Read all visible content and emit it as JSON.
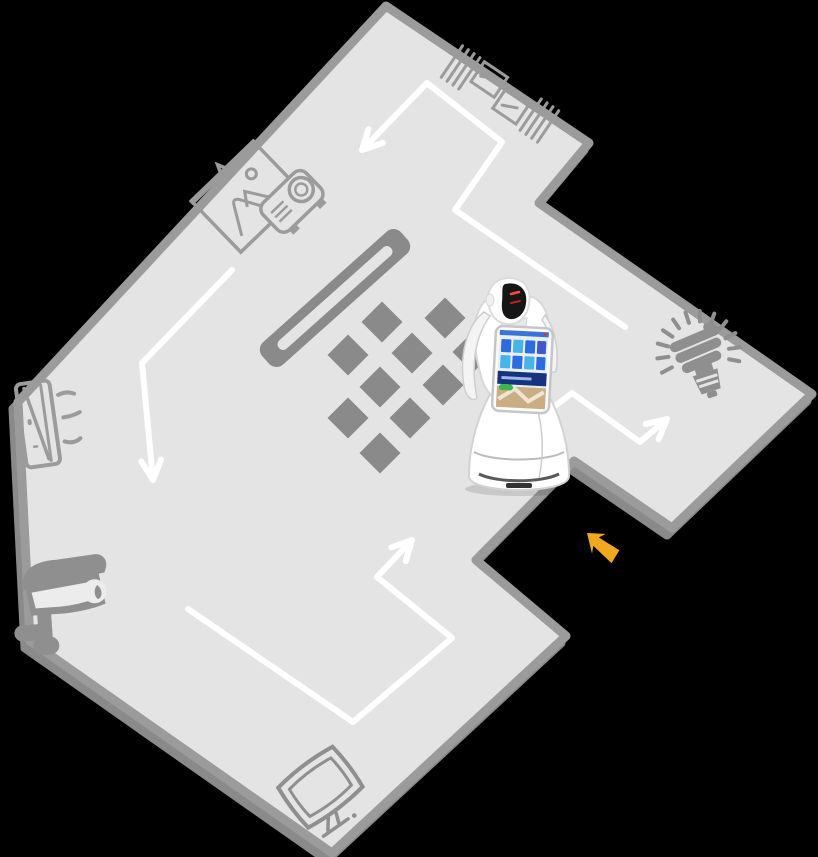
{
  "scene": {
    "description": "Top-down floor map showing a service robot patrol route among smart devices",
    "background": "#000000"
  },
  "colors": {
    "floor": "#e4e4e4",
    "wall": "#9b9b9b",
    "wall_shadow": "#8a8a8a",
    "tile": "#8a8a8a",
    "divider": "#8a8a8a",
    "divider_slot": "#e4e4e4",
    "route": "#ffffff",
    "icon_outline": "#9b9b9b",
    "icon_solid": "#8f8f8f",
    "entrance_arrow": "#efa91f",
    "robot_body": "#ffffff",
    "robot_visor": "#161616",
    "robot_eye": "#ff4a3d",
    "screen_bg": "#e8eef4",
    "screen_banner": "#17337e",
    "screen_green": "#3cb54b",
    "screen_photo": "#c9ad85",
    "tile_blue": "#2d6be0",
    "tile_cyan": "#45b4e8",
    "tile_navy": "#4157cc"
  },
  "floor": {
    "outline_points": "386,6 589,143 539,203 812,394 672,528 574,461 476,560 566,636 332,853 30,641 18,402"
  },
  "divider": {
    "transform": "translate(335,298) rotate(-41.8)"
  },
  "tiles": {
    "size": 29,
    "centers": [
      [
        382,
        322
      ],
      [
        445,
        318
      ],
      [
        348,
        355
      ],
      [
        412,
        353
      ],
      [
        473,
        352
      ],
      [
        380,
        387
      ],
      [
        443,
        385
      ],
      [
        509,
        386
      ],
      [
        348,
        418
      ],
      [
        410,
        418
      ],
      [
        380,
        453
      ]
    ]
  },
  "patrol_route": {
    "north_leg": {
      "d": "M362,150 L427,83 L502,142 L455,210 L625,327 M382.8,142.9 L362,150 L368.5,129"
    },
    "west_leg": {
      "d": "M232,270 L142,363 L153,480 M161.1,459.5 L153,480 L141.2,461.4"
    },
    "south_leg": {
      "d": "M188,609 L353,722 L452,638 L377,577 L412,540 M391.3,547.4 L412,540 L405.8,561.1"
    },
    "east_leg": {
      "d": "M515,437 L572,393 L640,442 L667,419 M645.6,424.1 L667,419 L658.6,439.3"
    }
  },
  "entrance_arrow": {
    "d": "M0,0 L15,-11 L12,-4 L36,-7 L38,8 L13,6 L17,13 Z",
    "transform": "translate(587,533) rotate(39)"
  },
  "equipment": {
    "items": [
      {
        "name": "wall-shelf"
      },
      {
        "name": "projector-and-screen"
      },
      {
        "name": "air-conditioner"
      },
      {
        "name": "cctv-camera"
      },
      {
        "name": "monitor"
      },
      {
        "name": "energy-saving-bulb"
      }
    ]
  },
  "robot": {
    "name": "service-robot",
    "position": "center-right of room"
  }
}
